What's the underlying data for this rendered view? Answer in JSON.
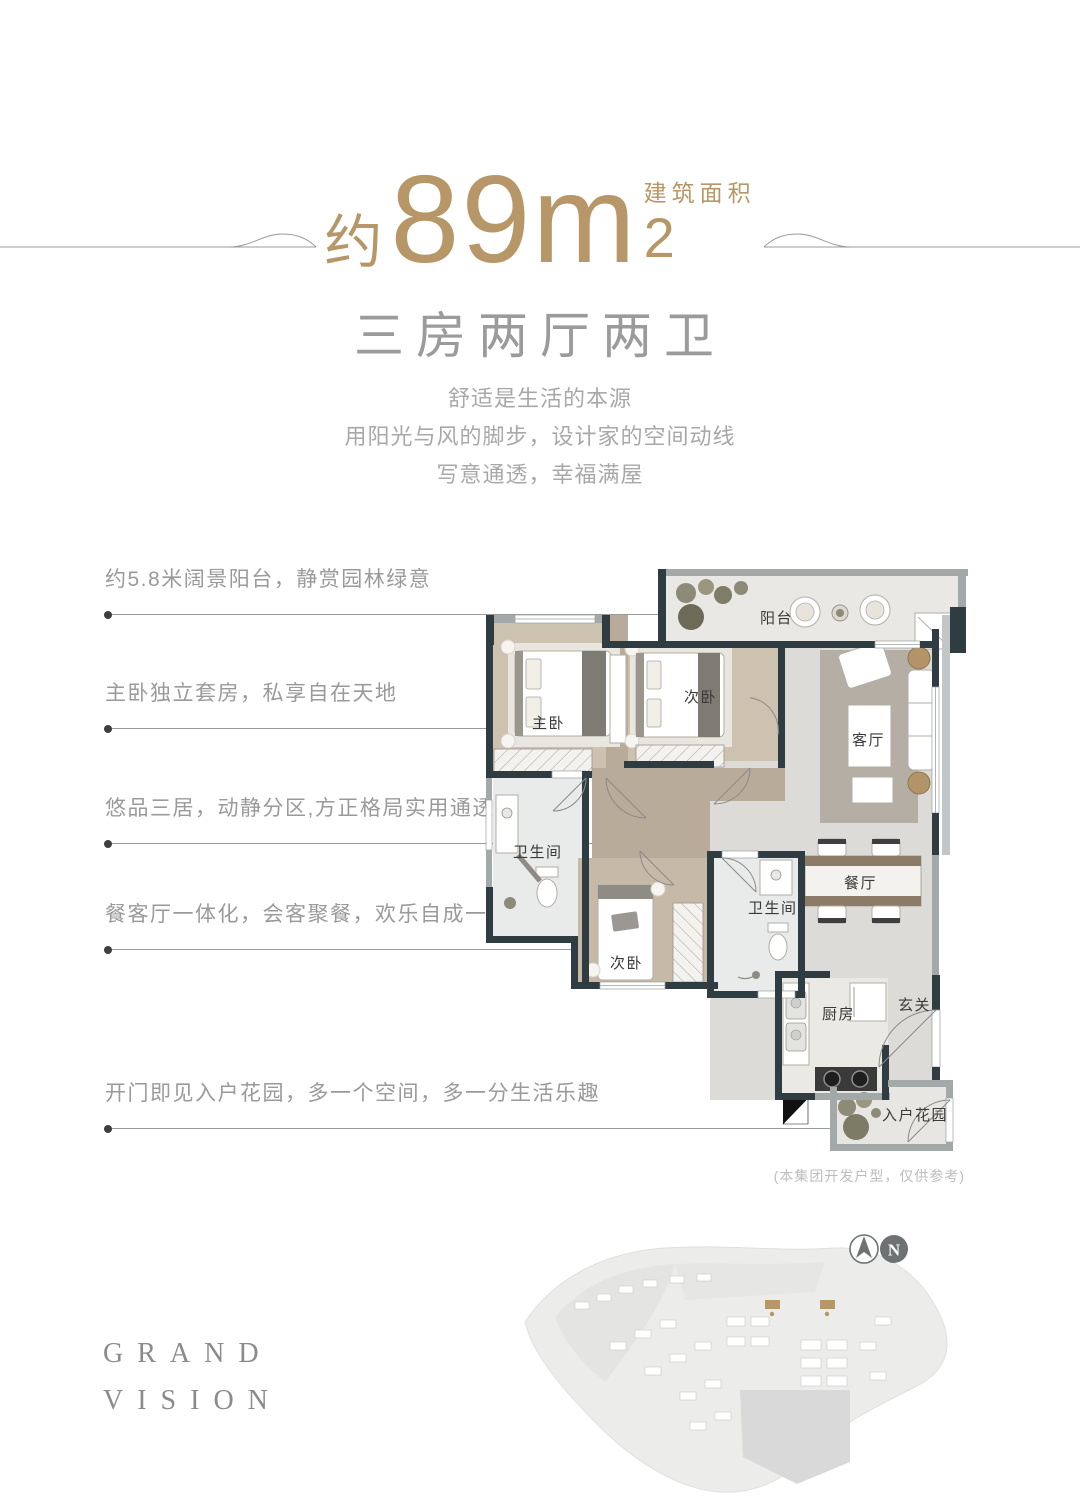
{
  "colors": {
    "accent_gold": "#b79767",
    "wall_dark": "#2f3d43",
    "text_gray": "#9a9a9a",
    "wood_floor": "#c6b9a8",
    "marble_floor": "#dcdbd8"
  },
  "header": {
    "area_prefix": "约",
    "area_number": "89m",
    "area_sup": "2",
    "area_label": "建筑面积",
    "subtitle": "三房两厅两卫",
    "desc_lines": [
      "舒适是生活的本源",
      "用阳光与风的脚步，设计家的空间动线",
      "写意通透，幸福满屋"
    ]
  },
  "bullets": [
    {
      "text": "约5.8米阔景阳台，静赏园林绿意"
    },
    {
      "text": "主卧独立套房，私享自在天地"
    },
    {
      "text": "悠品三居，动静分区,方正格局实用通透"
    },
    {
      "text": "餐客厅一体化，会客聚餐，欢乐自成一体"
    },
    {
      "text": "开门即见入户花园，多一个空间，多一分生活乐趣"
    }
  ],
  "floorplan": {
    "rooms": {
      "balcony": "阳台",
      "master": "主卧",
      "bedroom2": "次卧",
      "living": "客厅",
      "bath1": "卫生间",
      "bedroom3": "次卧",
      "bath2": "卫生间",
      "dining": "餐厅",
      "kitchen": "厨房",
      "entry": "玄关",
      "garden": "入户花园"
    },
    "note": "(本集团开发户型，仅供参考)"
  },
  "brand": {
    "line1": "GRAND",
    "line2": "VISION"
  },
  "compass": {
    "north_label": "N"
  }
}
